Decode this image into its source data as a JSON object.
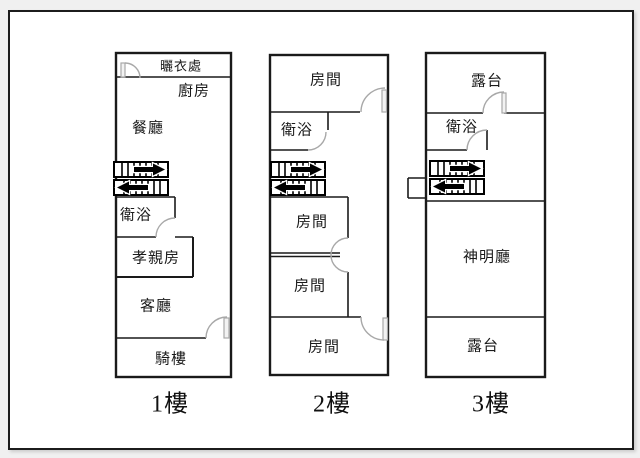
{
  "colors": {
    "background": "#f0f0f0",
    "paper": "#ffffff",
    "wall": "#1a1a1a",
    "door": "#a8a8a8",
    "stairs": "#000000"
  },
  "floors": [
    {
      "caption": "1樓",
      "rooms": [
        {
          "name": "曬衣處"
        },
        {
          "name": "廚房"
        },
        {
          "name": "餐廳"
        },
        {
          "name": "衛浴"
        },
        {
          "name": "孝親房"
        },
        {
          "name": "客廳"
        },
        {
          "name": "騎樓"
        }
      ]
    },
    {
      "caption": "2樓",
      "rooms": [
        {
          "name": "房間"
        },
        {
          "name": "衛浴"
        },
        {
          "name": "房間"
        },
        {
          "name": "房間"
        },
        {
          "name": "房間"
        }
      ]
    },
    {
      "caption": "3樓",
      "rooms": [
        {
          "name": "露台"
        },
        {
          "name": "衛浴"
        },
        {
          "name": "神明廳"
        },
        {
          "name": "露台"
        }
      ]
    }
  ]
}
